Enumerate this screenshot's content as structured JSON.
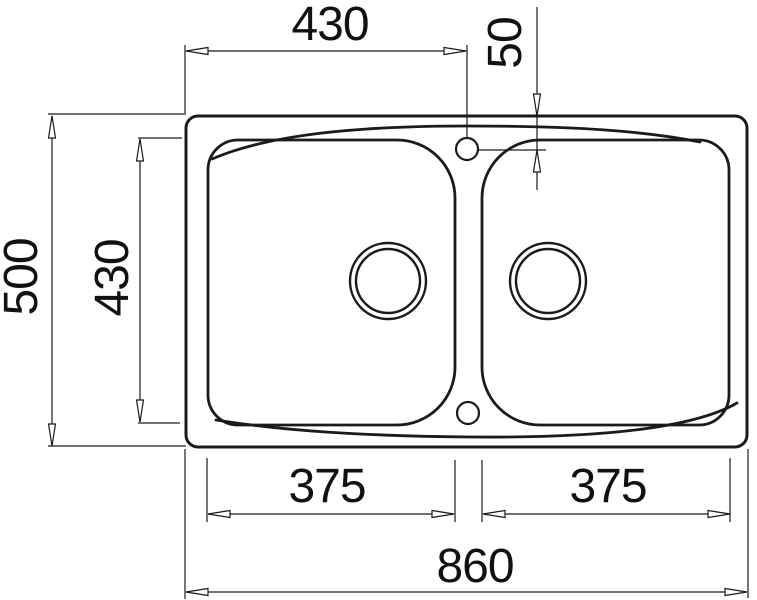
{
  "drawing": {
    "type": "technical-drawing-top-view-double-bowl-sink",
    "colors": {
      "background": "#ffffff",
      "line": "#1b1b1b",
      "text": "#111111"
    },
    "dimensions": {
      "top_width": "430",
      "tap_hole_offset": "50",
      "overall_depth": "500",
      "bowl_depth": "430",
      "left_bowl_width": "375",
      "right_bowl_width": "375",
      "overall_width": "860"
    }
  }
}
